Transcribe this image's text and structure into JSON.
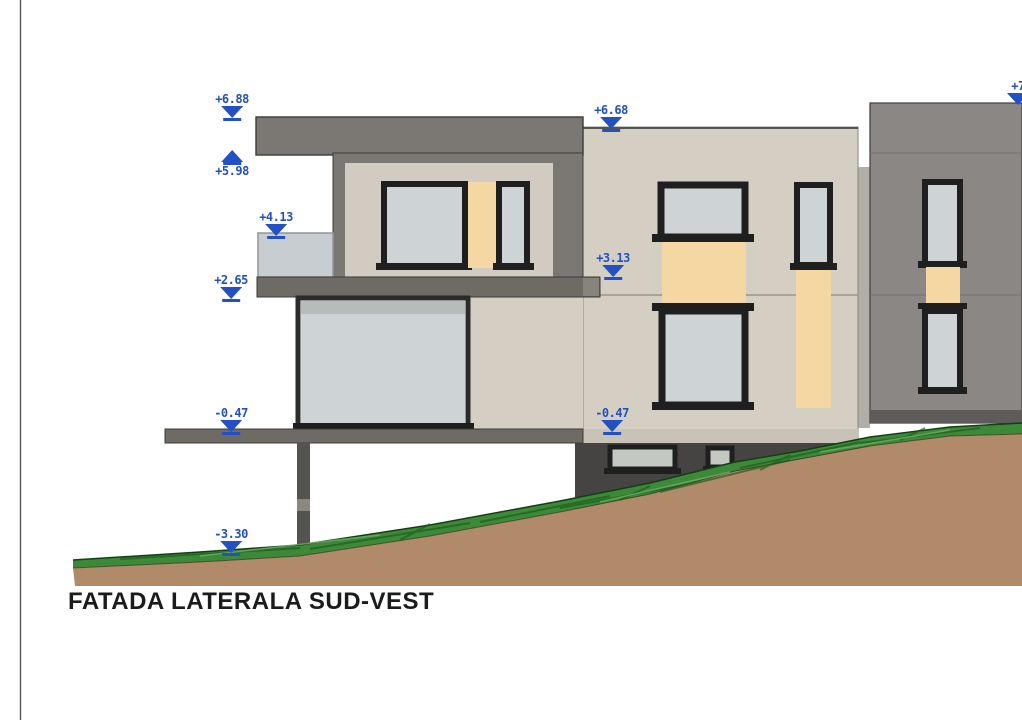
{
  "title": {
    "label": "FATADA LATERALA SUD-VEST"
  },
  "markers": [
    {
      "label": "+6.88",
      "dir": "down",
      "position": "left-roof-top"
    },
    {
      "label": "+5.98",
      "dir": "up",
      "position": "left-roof-underside"
    },
    {
      "label": "+4.13",
      "dir": "down",
      "position": "balcony-parapet-top"
    },
    {
      "label": "+2.65",
      "dir": "down",
      "position": "balcony-slab-top"
    },
    {
      "label": "+6.68",
      "dir": "down",
      "position": "center-roof-top"
    },
    {
      "label": "+3.13",
      "dir": "down",
      "position": "upper-floor-level"
    },
    {
      "label": "-0.47",
      "dir": "down",
      "position": "terrace-slab-left"
    },
    {
      "label": "-0.47",
      "dir": "down",
      "position": "terrace-slab-center"
    },
    {
      "label": "-3.30",
      "dir": "down",
      "position": "ground-level"
    },
    {
      "label": "+7",
      "dir": "down",
      "position": "right-roof-top-clipped"
    }
  ],
  "colors": {
    "marker_blue": "#2350c2",
    "facade_beige": "#d5cec3",
    "inset_beige": "#d1cbc2",
    "roof_gray": "#7b7873",
    "slab_gray": "#6e6b65",
    "right_building_gray": "#8a8784",
    "right_building_base": "#5d5c5a",
    "flank_gray": "#b1ada7",
    "basement_gray": "#454442",
    "glass_blue": "#ced4d6",
    "glass_basement": "#c4c8c3",
    "window_frame": "#1f1f1f",
    "orange_panel": "#f4d7a2",
    "parapet_glass": "#c7cdd1",
    "column_gray": "#55534e",
    "grass_green": "#3c8a38",
    "grass_dark": "#1c5a1e",
    "earth_brown": "#b18a69",
    "title_color": "#1b1b1b"
  }
}
